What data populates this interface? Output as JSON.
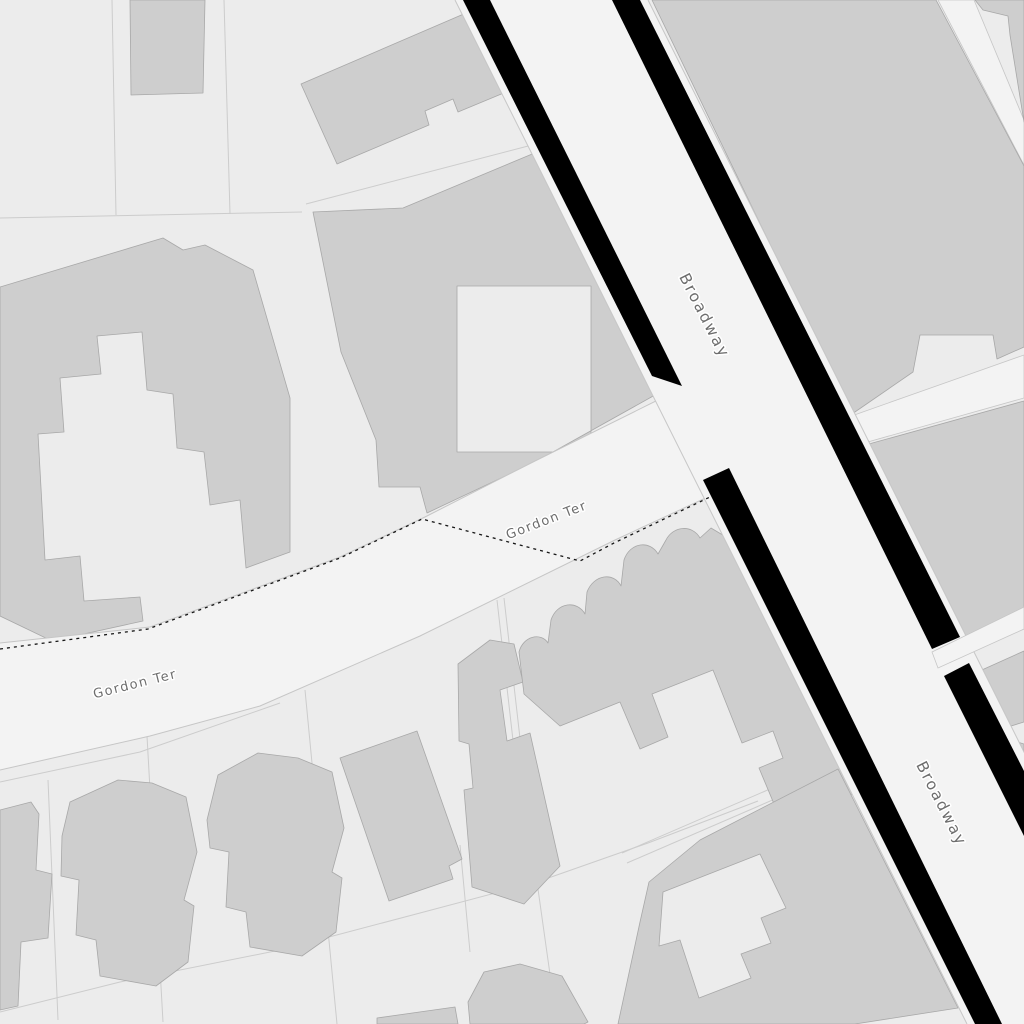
{
  "map": {
    "type": "monochrome-street-map-tile",
    "colors": {
      "background": "#ececec",
      "road_fill": "#f3f3f3",
      "casing": "#000000",
      "building_fill": "#cecece",
      "building_stroke": "#a8a8a8",
      "hairline": "#c6c6c6",
      "parcel_line": "#cccccc",
      "boundary": "#161616",
      "label": "#6d6d6d",
      "label_halo": "#ffffff"
    },
    "roads": [
      {
        "name": "Broadway",
        "style": "major-black-casing"
      },
      {
        "name": "Gordon Ter",
        "style": "minor-hairline"
      }
    ],
    "labels": [
      {
        "id": "gordon-ter-west",
        "text": "Gordon Ter",
        "x": 136,
        "y": 688,
        "rotation": -14,
        "size": 13,
        "letter_spacing": 1.5
      },
      {
        "id": "gordon-ter-east",
        "text": "Gordon Ter",
        "x": 548,
        "y": 524,
        "rotation": -21,
        "size": 13,
        "letter_spacing": 1.5
      },
      {
        "id": "broadway-north",
        "text": "Broadway",
        "x": 700,
        "y": 318,
        "rotation": 63,
        "size": 15.5,
        "letter_spacing": 2
      },
      {
        "id": "broadway-south",
        "text": "Broadway",
        "x": 937,
        "y": 806,
        "rotation": 63,
        "size": 15.5,
        "letter_spacing": 2
      }
    ],
    "geometry": {
      "parcel_lines": [
        "112,0 116,215",
        "224,0 230,214",
        "0,218 302,212",
        "306,204 532,145",
        "48,780 58,1020",
        "147,736 163,1022",
        "305,690 337,1024",
        "460,845 470,952",
        "0,1012 120,982 280,950 420,913 537,882 648,843 758,801",
        "537,882 557,1024",
        "497,600 528,872",
        "504,598 535,870",
        "622,853 830,763",
        "627,863 835,773",
        "0,782 140,752 280,703"
      ],
      "walkways_under": [
        "M938,0 L974,0 L1024,120 L1024,165 Z",
        "M843,419 L1024,355 L1024,398 L857,445 Z"
      ],
      "walkways_over": [
        "M932,652 L1024,607 L1024,629 L938,668 Z"
      ],
      "buildings": [
        {
          "id": "nw-small",
          "path": "M130,0 L205,0 L203,93 L131,95 Z"
        },
        {
          "id": "nw-long",
          "path": "M301,84 L473,10 L552,73 L458,112 L453,99 L425,111 L429,125 L337,164 Z"
        },
        {
          "id": "center-court",
          "path": "M313,212 L403,208 L537,152 L575,237 L655,395 L535,462 L427,513 L420,487 L379,487 L376,440 L341,352 Z M457,286 L591,286 L591,452 L457,452 Z"
        },
        {
          "id": "west-complex",
          "path": "M0,287 L163,238 L183,250 L205,245 L253,270 L290,398 L290,552 L246,568 L240,500 L210,505 L204,452 L177,448 L173,394 L147,390 L142,332 L97,336 L101,374 L60,378 L64,432 L38,434 L45,560 L80,556 L84,601 L140,597 L143,621 L52,641 L0,616 Z"
        },
        {
          "id": "house-1",
          "path": "M0,810 L31,802 L39,814 L36,870 L52,874 L48,938 L21,942 L18,1006 L0,1010 Z"
        },
        {
          "id": "house-2",
          "path": "M62,836 L70,802 L118,780 L152,783 L186,797 L197,852 L184,900 L194,906 L188,962 L156,986 L100,976 L96,940 L76,935 L79,880 L61,876 Z"
        },
        {
          "id": "house-3",
          "path": "M207,820 L218,775 L258,753 L298,758 L332,772 L344,828 L332,872 L342,878 L336,932 L302,956 L250,947 L246,912 L226,907 L229,852 L210,848 Z"
        },
        {
          "id": "house-4",
          "path": "M340,758 L417,731 L462,859 L449,866 L453,879 L389,901 Z"
        },
        {
          "id": "house-5",
          "path": "M458,664 L490,640 L514,644 L523,682 L500,690 L507,741 L530,733 L560,866 L524,904 L472,887 L464,790 L473,788 L469,744 L459,741 Z"
        },
        {
          "id": "scalloped-block",
          "path": "M524,694 L519,652 C523,636 541,632 548,643 L551,620 C557,602 577,600 585,614 L587,592 C594,574 614,572 621,586 L624,560 C630,542 650,540 658,554 L666,540 C673,526 692,524 700,538 L711,528 L736,543 L858,792 L782,823 L759,768 L783,758 L773,731 L742,743 L713,670 L652,694 L668,737 L640,749 L620,702 L560,726 Z"
        },
        {
          "id": "se-block",
          "path": "M640,922 L649,882 L700,840 L838,769 L958,1008 L855,1024 L618,1024 Z M663,892 L760,854 L786,908 L761,918 L771,943 L741,954 L751,978 L699,998 L680,940 L659,946 Z"
        },
        {
          "id": "house-8",
          "path": "M468,1002 L484,972 L520,964 L562,976 L588,1022 L584,1024 L470,1024 Z"
        },
        {
          "id": "house-9",
          "path": "M377,1018 L455,1007 L458,1024 L377,1024 Z"
        },
        {
          "id": "ne-corner",
          "path": "M975,0 L1024,0 L1024,122 L1010,35 L1008,16 L983,10 Z"
        },
        {
          "id": "ne-big-block",
          "path": "M652,0 L936,0 L1024,166 L1024,347 L997,359 L993,335 L920,335 L913,372 L852,414 Z"
        },
        {
          "id": "e-mid-block",
          "path": "M858,447 L1024,401 L1024,612 L952,648 Z"
        },
        {
          "id": "e-low-block",
          "path": "M964,678 L1024,651 L1024,722 L1011,726 L1014,741 L1024,744 L1024,845 L1002,800 Z"
        }
      ],
      "gordon_ter_surface": "M0,643 L150,627 L340,557 L425,517 L535,461 L672,393 L700,382 L745,478 L712,495 L615,540 L420,636 L260,706 L150,736 L0,770 Z",
      "gordon_ter_edges": [
        "0,643 150,627 340,557 425,517 535,461 668,395",
        "712,495 615,540 420,636 260,706 150,736 0,770"
      ],
      "broadway_surface": "M455,0 L648,0 L1160,1024 L967,1024 Z",
      "broadway_edges": [
        "455,0 967,1024",
        "648,0 1160,1024"
      ],
      "casings": [
        "M463,0 L490,0 L682,386 L652,376 Z",
        "M703,480 L729,468 L1002,1024 L975,1024 Z",
        "M612,0 L640,0 L960,637 L932,649 Z",
        "M944,676 L969,663 L1024,771 L1024,836 Z"
      ],
      "boundary_line": "0,649 148,629 340,558 422,519 580,561 614,543 710,497"
    }
  }
}
